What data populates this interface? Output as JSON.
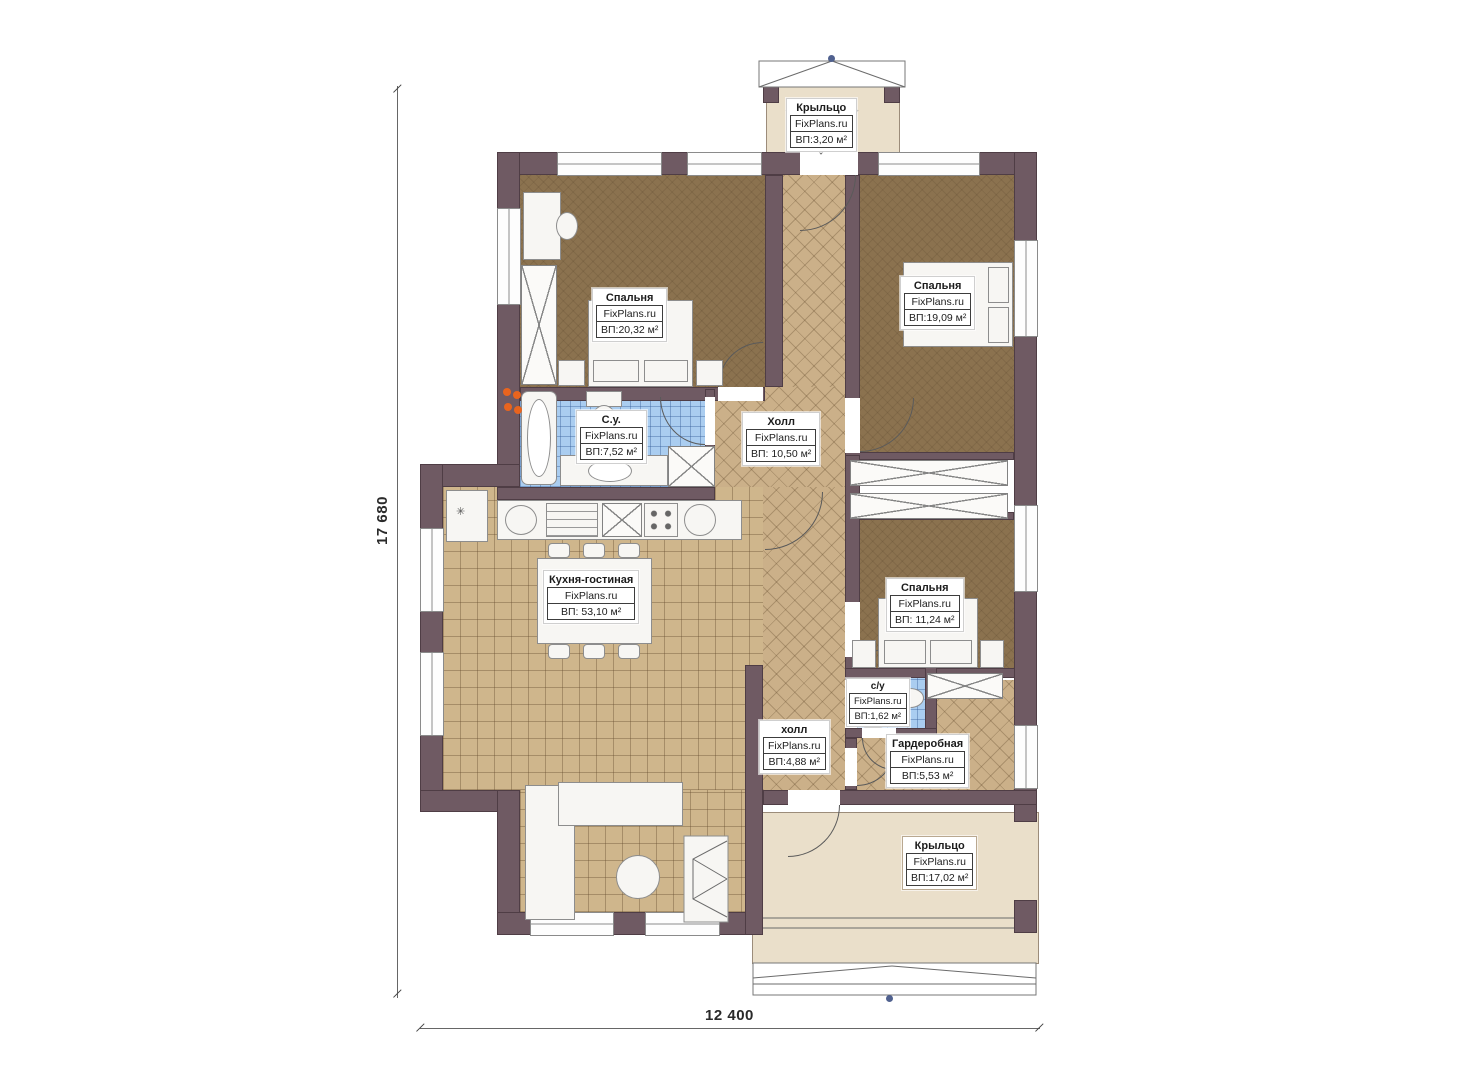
{
  "watermark": "FixPlans.ru",
  "dimensions": {
    "left_label": "17 680",
    "bottom_label": "12 400"
  },
  "rooms": {
    "porch_top": {
      "name": "Крыльцо",
      "brand": "FixPlans.ru",
      "area": "ВП:3,20 м²"
    },
    "bedroom1": {
      "name": "Спальня",
      "brand": "FixPlans.ru",
      "area": "ВП:20,32 м²"
    },
    "bedroom2": {
      "name": "Спальня",
      "brand": "FixPlans.ru",
      "area": "ВП:19,09 м²"
    },
    "bathroom": {
      "name": "С.у.",
      "brand": "FixPlans.ru",
      "area": "ВП:7,52 м²"
    },
    "hall": {
      "name": "Холл",
      "brand": "FixPlans.ru",
      "area": "ВП: 10,50 м²"
    },
    "kitchen": {
      "name": "Кухня-гостиная",
      "brand": "FixPlans.ru",
      "area": "ВП: 53,10 м²"
    },
    "bedroom3": {
      "name": "Спальня",
      "brand": "FixPlans.ru",
      "area": "ВП: 11,24 м²"
    },
    "wc": {
      "name": "с/у",
      "brand": "FixPlans.ru",
      "area": "ВП:1,62 м²"
    },
    "hall2": {
      "name": "холл",
      "brand": "FixPlans.ru",
      "area": "ВП:4,88 м²"
    },
    "wardrobe": {
      "name": "Гардеробная",
      "brand": "FixPlans.ru",
      "area": "ВП:5,53 м²"
    },
    "porch_bottom": {
      "name": "Крыльцо",
      "brand": "FixPlans.ru",
      "area": "ВП:17,02 м²"
    }
  },
  "colors": {
    "wall": "#6f5a63",
    "carpet": "#8b724f",
    "tile": "#cfb68c",
    "hall_hatch": "#cbb089",
    "bath_tile": "#aacdf0",
    "porch": "#eadfca",
    "radiator": "#e8641e",
    "roof_marker": "#50618f"
  }
}
